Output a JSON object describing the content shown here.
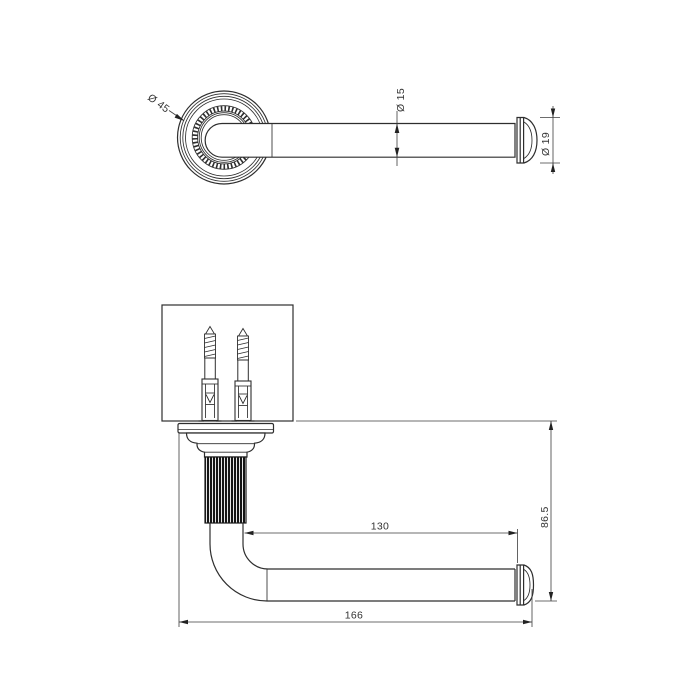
{
  "drawing": {
    "front_view": {
      "rosette_diameter_label": "Ø 45",
      "bar_diameter_label": "Ø 15",
      "cap_diameter_label": "Ø 19"
    },
    "section_view": {
      "arm_length_label": "130",
      "projection_label": "86.5",
      "overall_length_label": "166"
    },
    "colors": {
      "background": "#ffffff",
      "object_line": "#2e2e2e",
      "dimension_line": "#3c3c3c",
      "text": "#333333"
    }
  }
}
